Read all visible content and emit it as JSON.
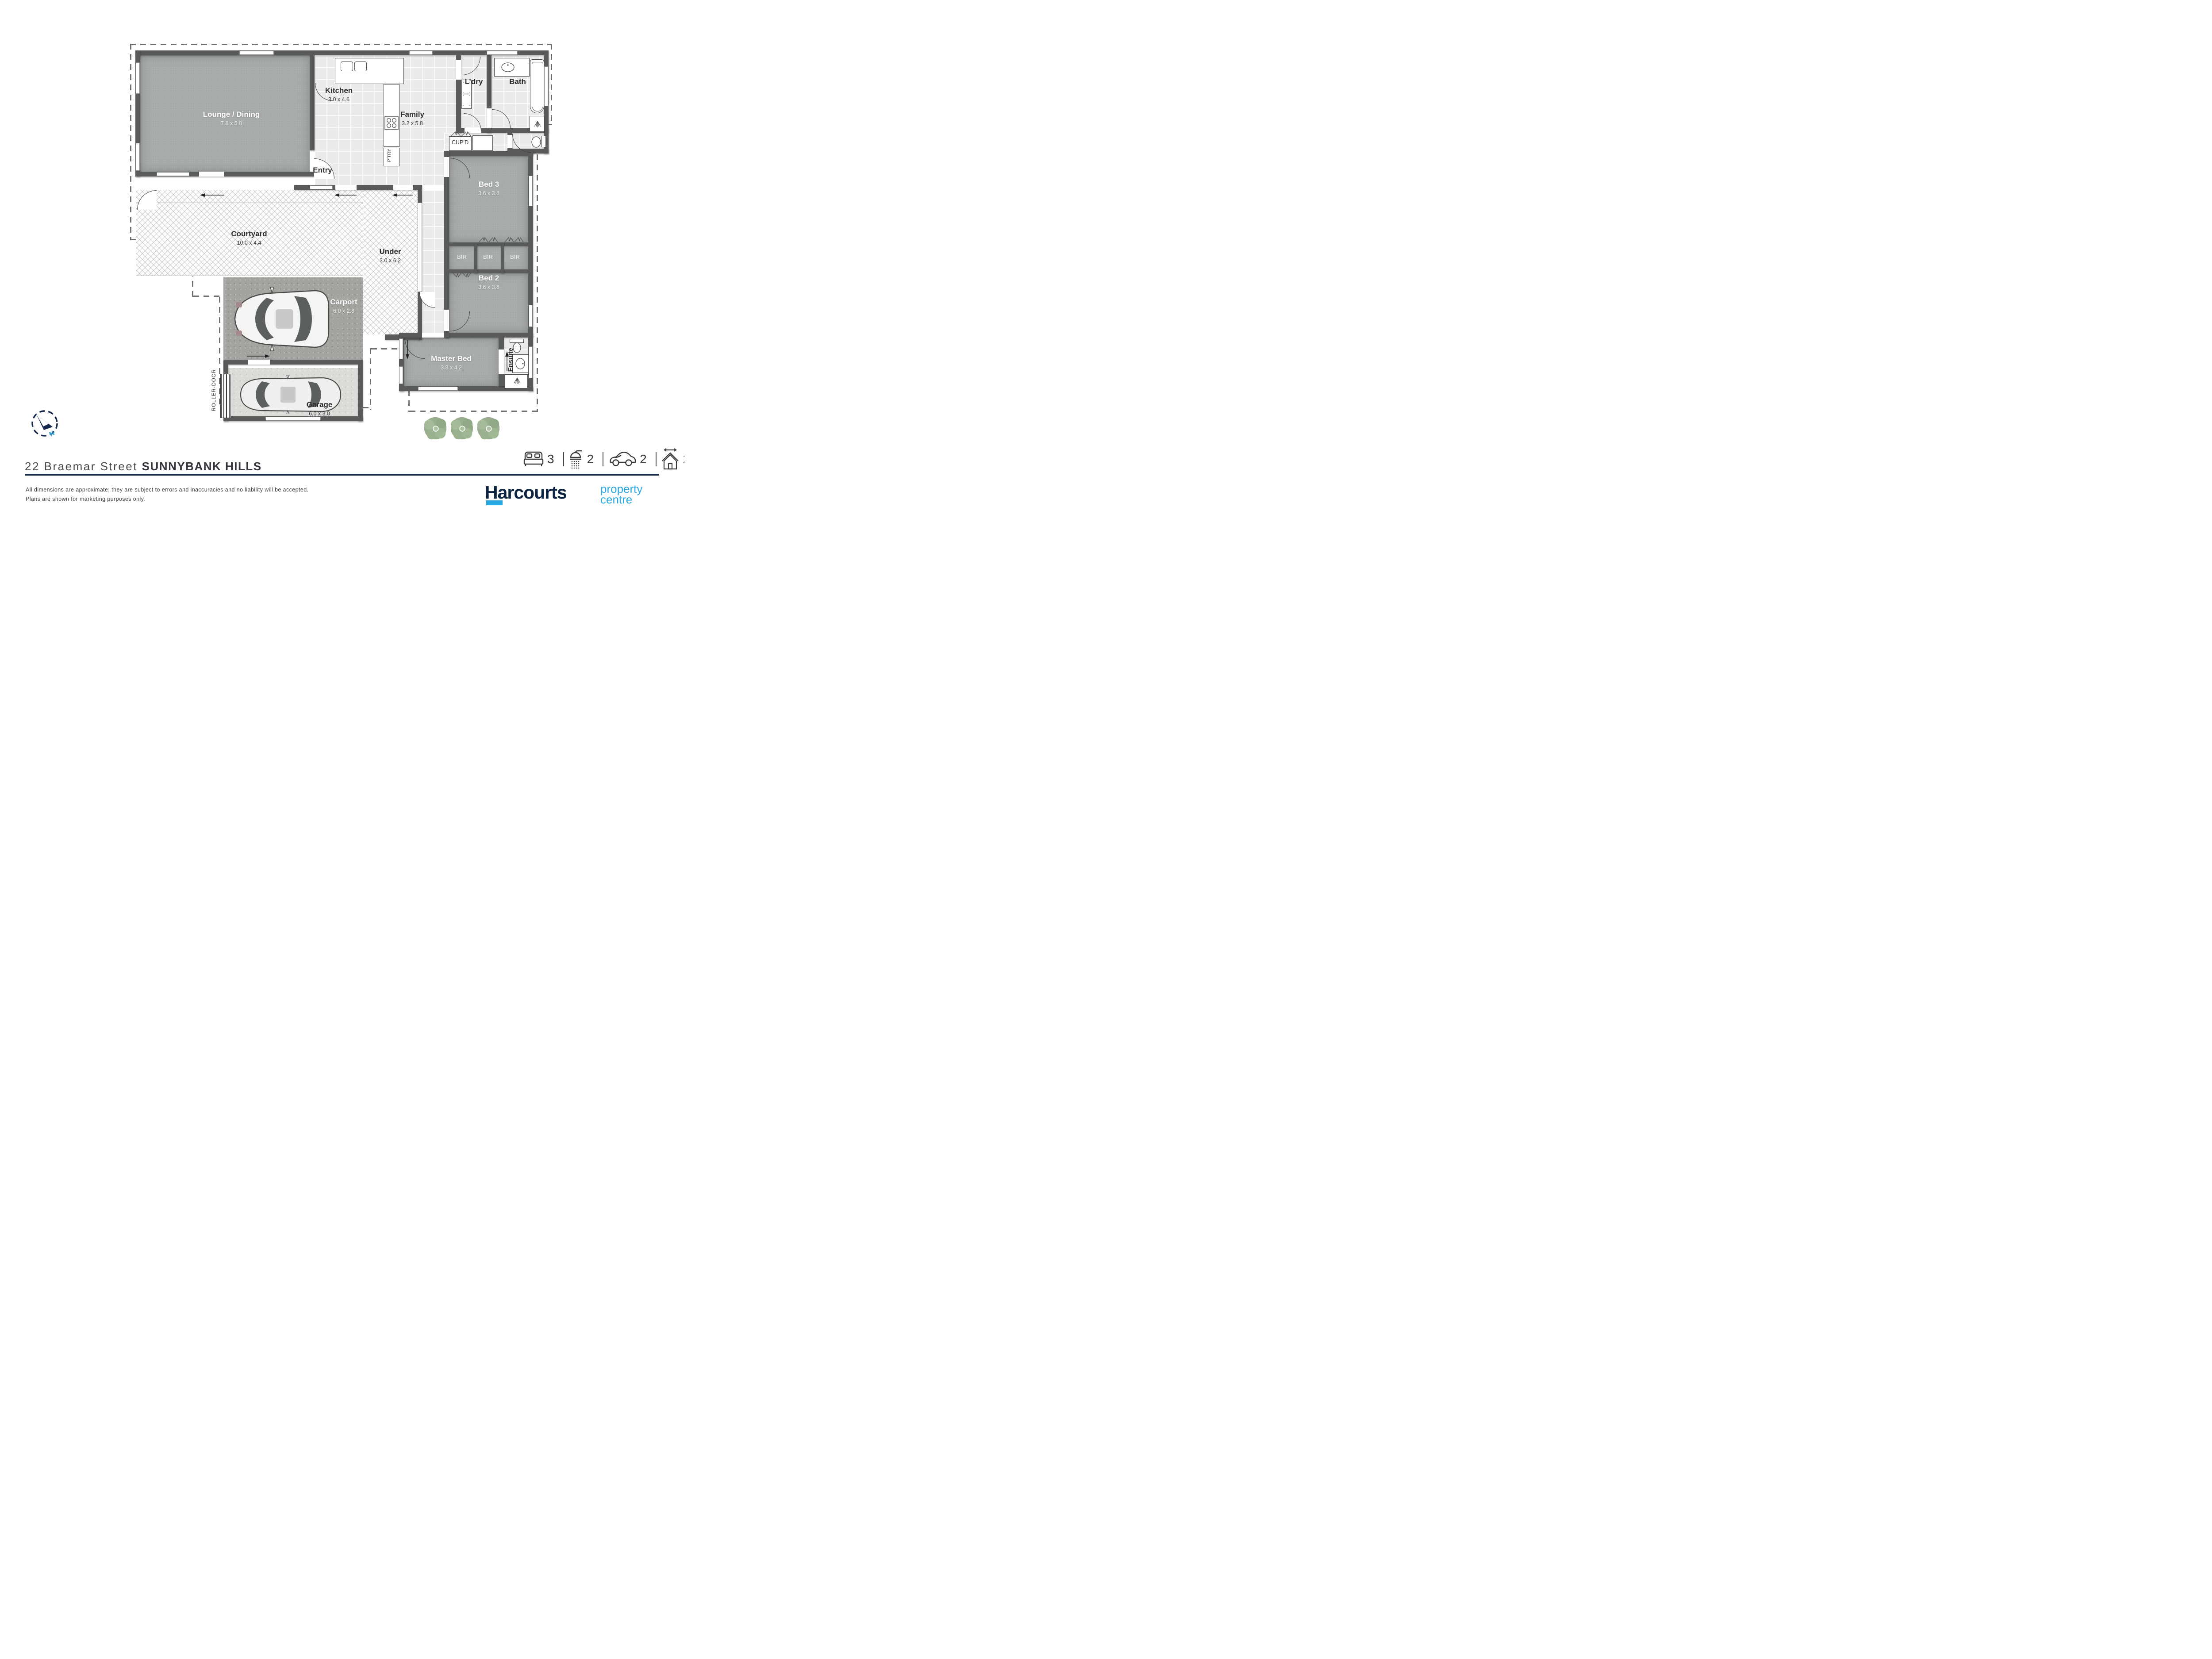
{
  "rooms": {
    "lounge": {
      "name": "Lounge / Dining",
      "dims": "7.8 x 5.8"
    },
    "kitchen": {
      "name": "Kitchen",
      "dims": "3.0 x 4.6"
    },
    "family": {
      "name": "Family",
      "dims": "3.2 x 5.8"
    },
    "entry": {
      "name": "Entry"
    },
    "laundry": {
      "name": "L’dry"
    },
    "bath": {
      "name": "Bath"
    },
    "cupboard": {
      "name": "CUP’D"
    },
    "pantry": {
      "name": "P’TRY"
    },
    "bed3": {
      "name": "Bed 3",
      "dims": "3.6 x 3.8"
    },
    "bed2": {
      "name": "Bed 2",
      "dims": "3.6 x 3.8"
    },
    "bir": {
      "name": "BIR"
    },
    "master": {
      "name": "Master Bed",
      "dims": "3.8 x 4.2"
    },
    "ensuite": {
      "name": "Ensuite"
    },
    "courtyard": {
      "name": "Courtyard",
      "dims": "10.0 x 4.4"
    },
    "under": {
      "name": "Under",
      "dims": "3.0 x 6.2"
    },
    "carport": {
      "name": "Carport",
      "dims": "6.0 x 2.8"
    },
    "garage": {
      "name": "Garage",
      "dims": "6.0 x 3.0"
    },
    "roller_door": {
      "name": "ROLLER-DOOR"
    }
  },
  "compass": {
    "north": "N"
  },
  "footer": {
    "address_street": "22 Braemar Street",
    "address_suburb": "SUNNYBANK HILLS",
    "disclaimer1": "All dimensions are approximate; they are subject to errors and inaccuracies and no liability will be accepted.",
    "disclaimer2": "Plans are shown for marketing purposes only.",
    "stats": {
      "beds": "3",
      "baths": "2",
      "cars": "2",
      "area": "266m",
      "area_sup": "2"
    },
    "brand": {
      "name": "Harcourts",
      "line1": "property",
      "line2": "centre"
    }
  },
  "colors": {
    "navy": "#0d2342",
    "light_blue": "#29aae2",
    "wall": "#595b5a",
    "carpet": "#a7aba8",
    "tile": "#ebecea"
  }
}
